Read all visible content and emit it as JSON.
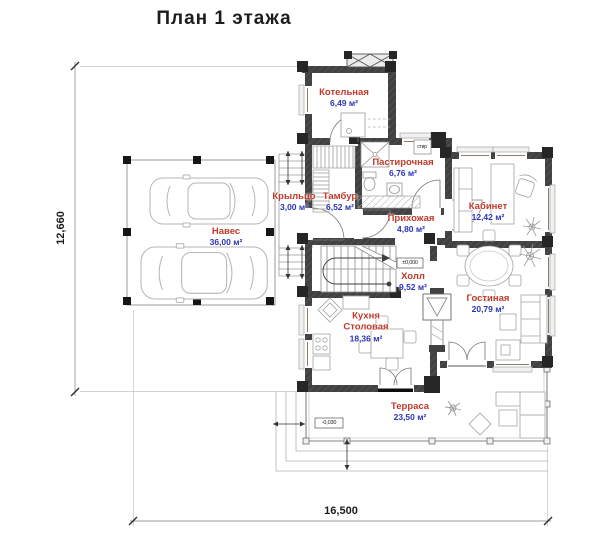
{
  "title": "План 1 этажа",
  "colors": {
    "room-name": "#c2392a",
    "room-area": "#2b35b5",
    "wall": "#414141",
    "dimension-text": "#1c1c1c"
  },
  "rooms": [
    {
      "name": "Котельная",
      "area": "6,49 м²"
    },
    {
      "name": "Пастирочная",
      "area": "6,76 м²"
    },
    {
      "name": "Тамбур",
      "area": "6,52 м²"
    },
    {
      "name": "Прихожая",
      "area": "4,80 м²"
    },
    {
      "name": "Кабинет",
      "area": "12,42 м²"
    },
    {
      "name": "Холл",
      "area": "9,52 м²"
    },
    {
      "name": "Гостиная",
      "area": "20,79 м²"
    },
    {
      "name": "Кухня",
      "name_line2": "Столовая",
      "area": "18,36 м²"
    },
    {
      "name": "Терраса",
      "area": "23,50 м²"
    },
    {
      "name": "Крыльцо",
      "area": "3,00 м²"
    },
    {
      "name": "Навес",
      "area": "36,00 м²"
    }
  ],
  "dimensions": {
    "bottom": "16,500",
    "left": "12,660"
  },
  "elevation_marks": {
    "hall": "±0,000",
    "terrace": "-0,030"
  },
  "appliance_labels": {
    "washer": "стир"
  }
}
